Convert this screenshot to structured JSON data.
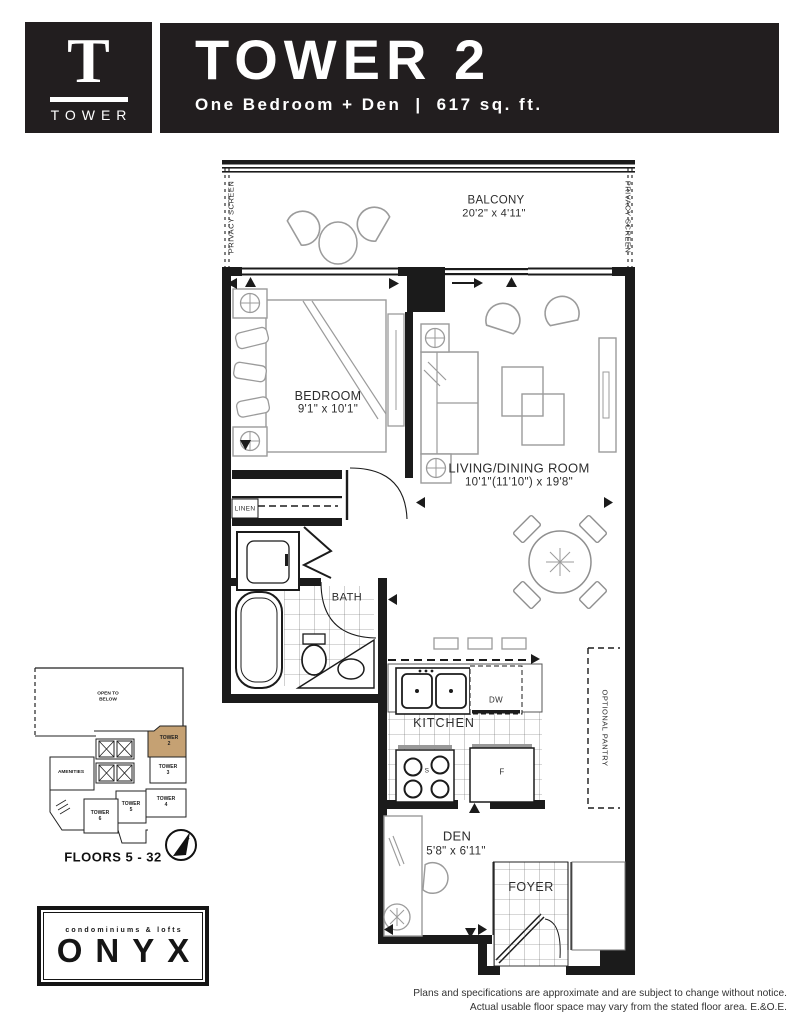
{
  "header": {
    "logo": {
      "letter": "T",
      "word": "TOWER"
    },
    "title": "TOWER 2",
    "subtitle": {
      "left": "One Bedroom + Den",
      "sep": "|",
      "right": "617 sq. ft."
    }
  },
  "plan": {
    "balcony": {
      "name": "BALCONY",
      "dims": "20'2\" x 4'11\""
    },
    "privacy_left": "PRIVACY SCREEN",
    "privacy_right": "PRIVACY SCREEN",
    "bedroom": {
      "name": "BEDROOM",
      "dims": "9'1\" x 10'1\""
    },
    "living": {
      "name": "LIVING/DINING ROOM",
      "dims": "10'1\"(11'10\") x 19'8\""
    },
    "linen": "LINEN",
    "bath": "BATH",
    "kitchen": "KITCHEN",
    "dishwasher": "DW",
    "stove": "S",
    "fridge": "F",
    "pantry": "OPTIONAL PANTRY",
    "den": {
      "name": "DEN",
      "dims": "5'8\" x 6'11\""
    },
    "foyer": "FOYER"
  },
  "keyplan": {
    "open_to_below": "OPEN TO BELOW",
    "amenities": "AMENITIES",
    "towers": [
      {
        "word": "TOWER",
        "num": "2"
      },
      {
        "word": "TOWER",
        "num": "3"
      },
      {
        "word": "TOWER",
        "num": "4"
      },
      {
        "word": "TOWER",
        "num": "5"
      },
      {
        "word": "TOWER",
        "num": "6"
      }
    ],
    "floors": "FLOORS 5 - 32",
    "highlight_color": "#c5a173"
  },
  "brand": {
    "tagline": "condominiums & lofts",
    "name": "ONYX"
  },
  "disclaimer": {
    "line1": "Plans and specifications are approximate and are subject to change without notice.",
    "line2": "Actual usable floor space may vary from the stated floor area. E.&O.E."
  }
}
